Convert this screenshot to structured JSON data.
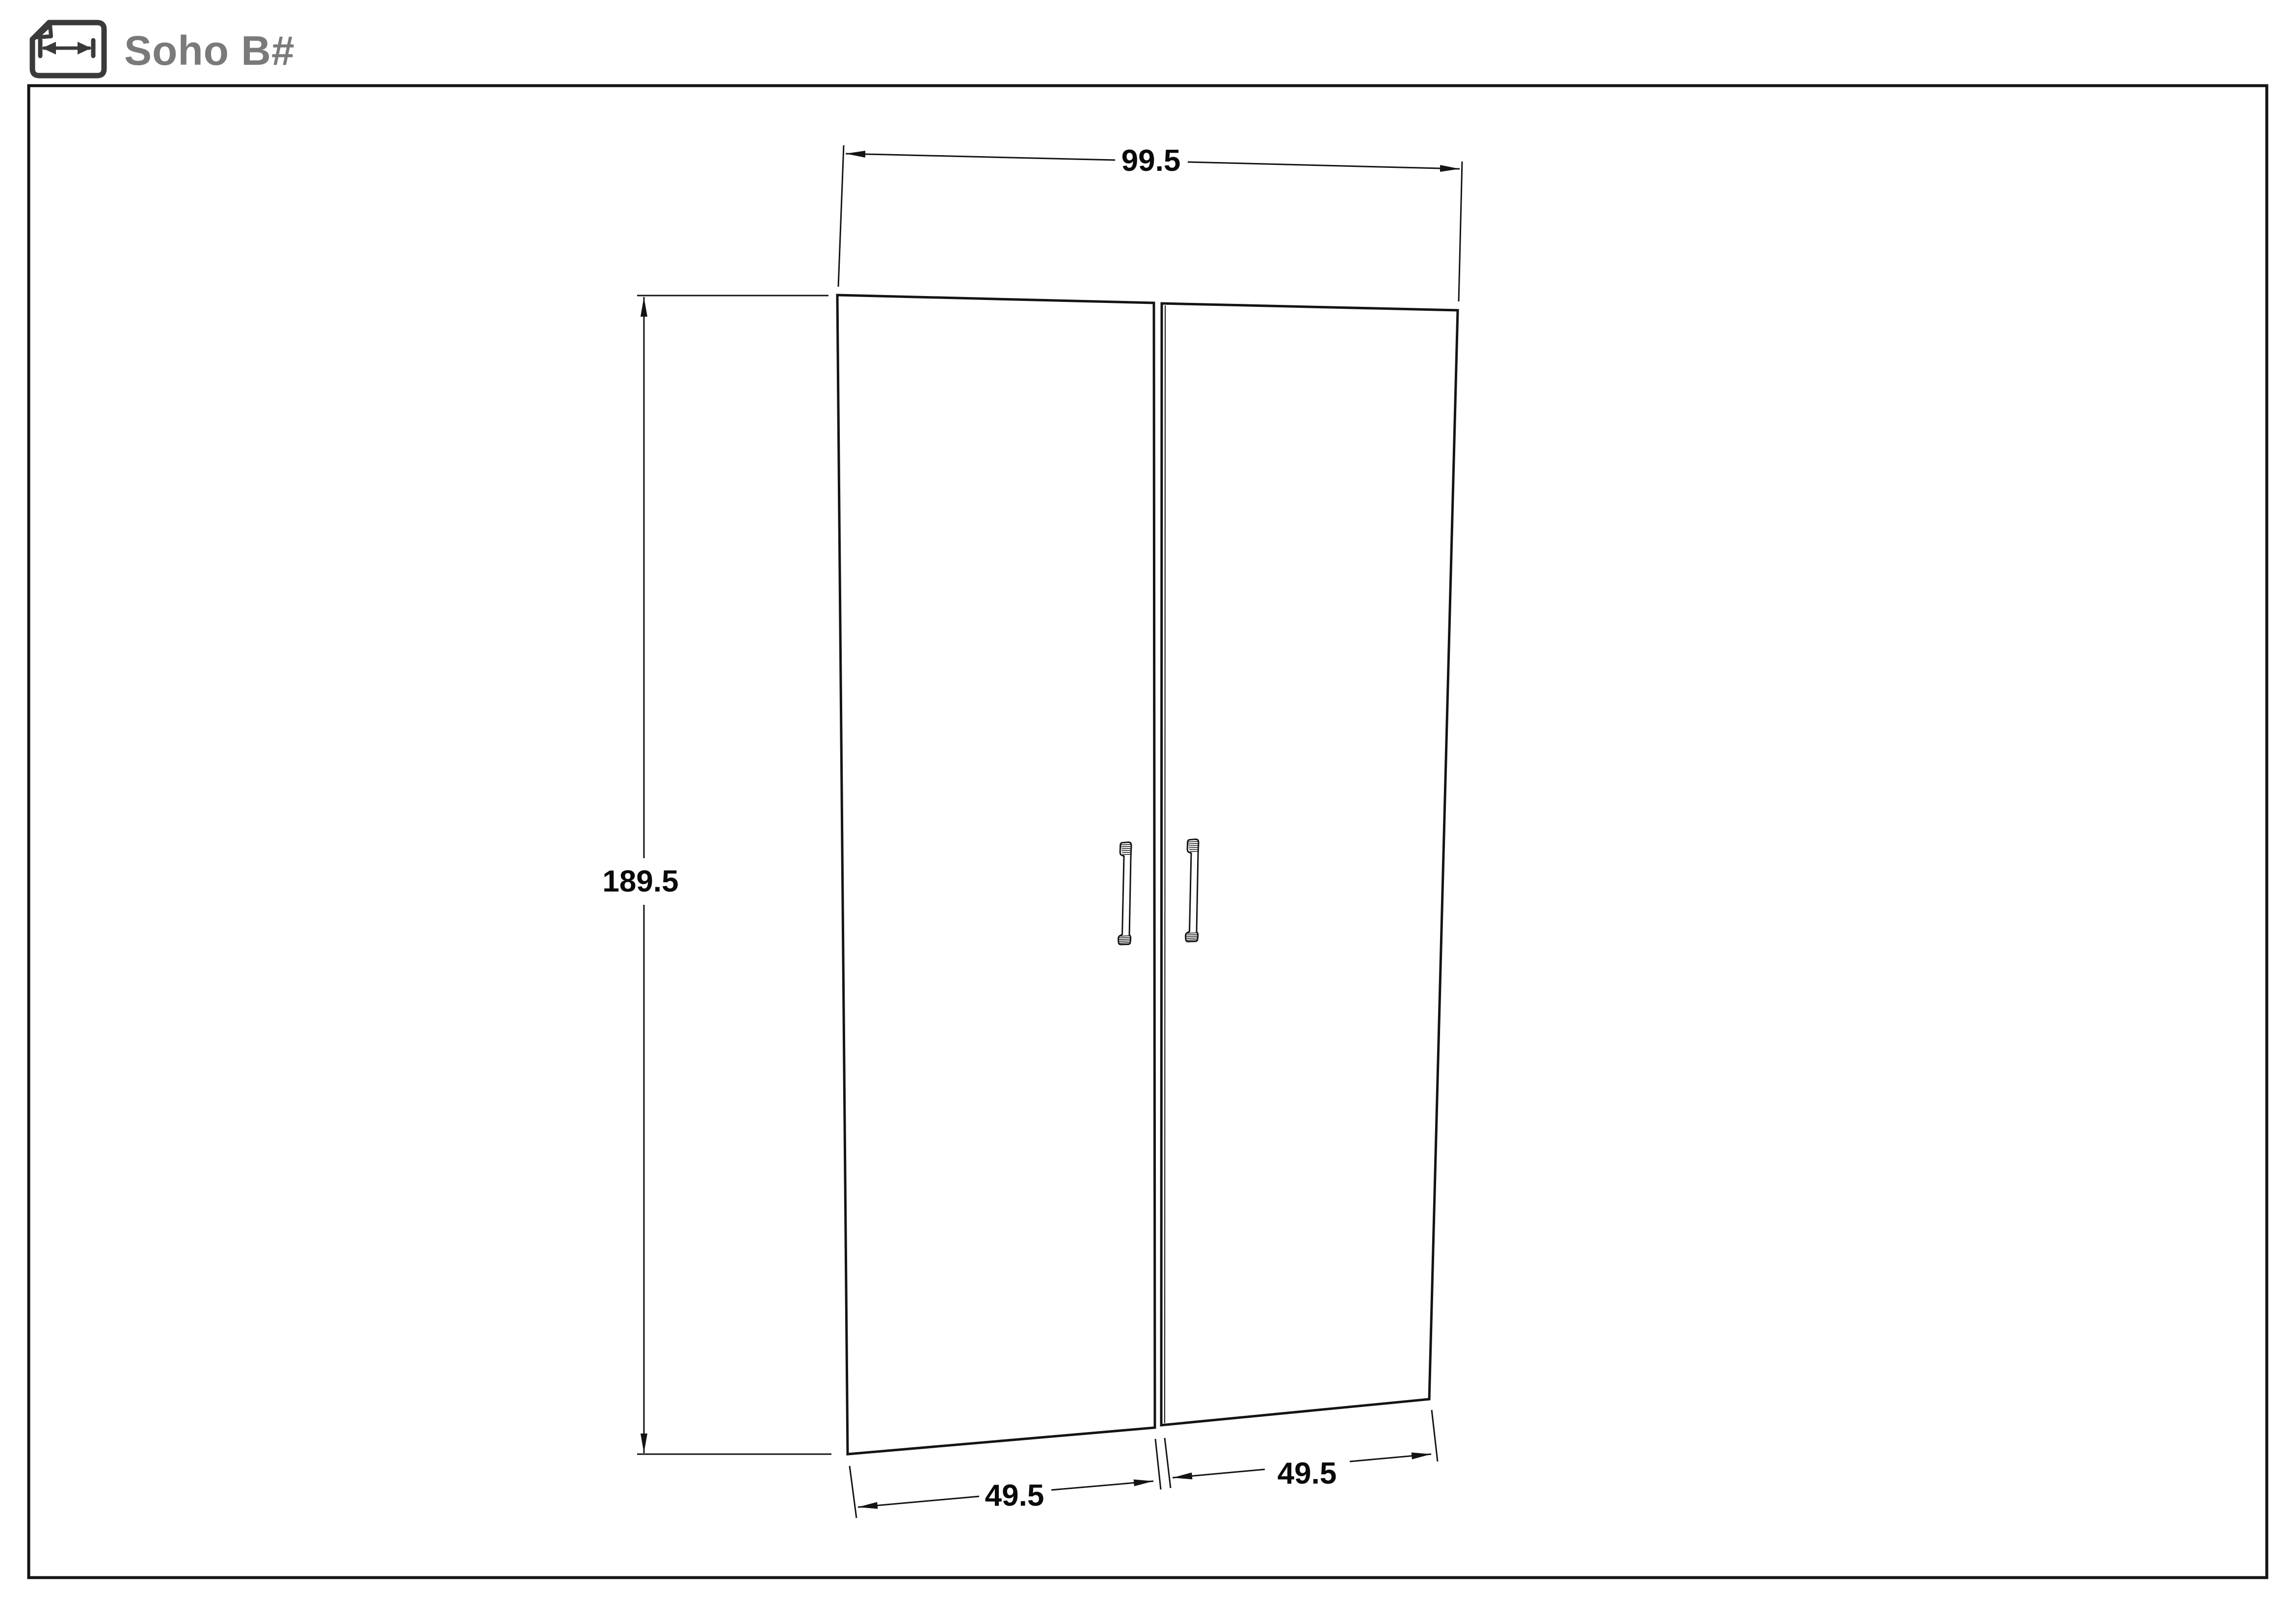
{
  "header": {
    "title": "Soho B#",
    "title_color": "#7a7a7a",
    "icon": "page-width-dimension-icon",
    "icon_color": "#3a3a3a"
  },
  "drawing": {
    "line_color": "#141414",
    "background": "#ffffff",
    "dimensions": {
      "total_width": "99.5",
      "height": "189.5",
      "left_door_width": "49.5",
      "right_door_width": "49.5"
    }
  }
}
